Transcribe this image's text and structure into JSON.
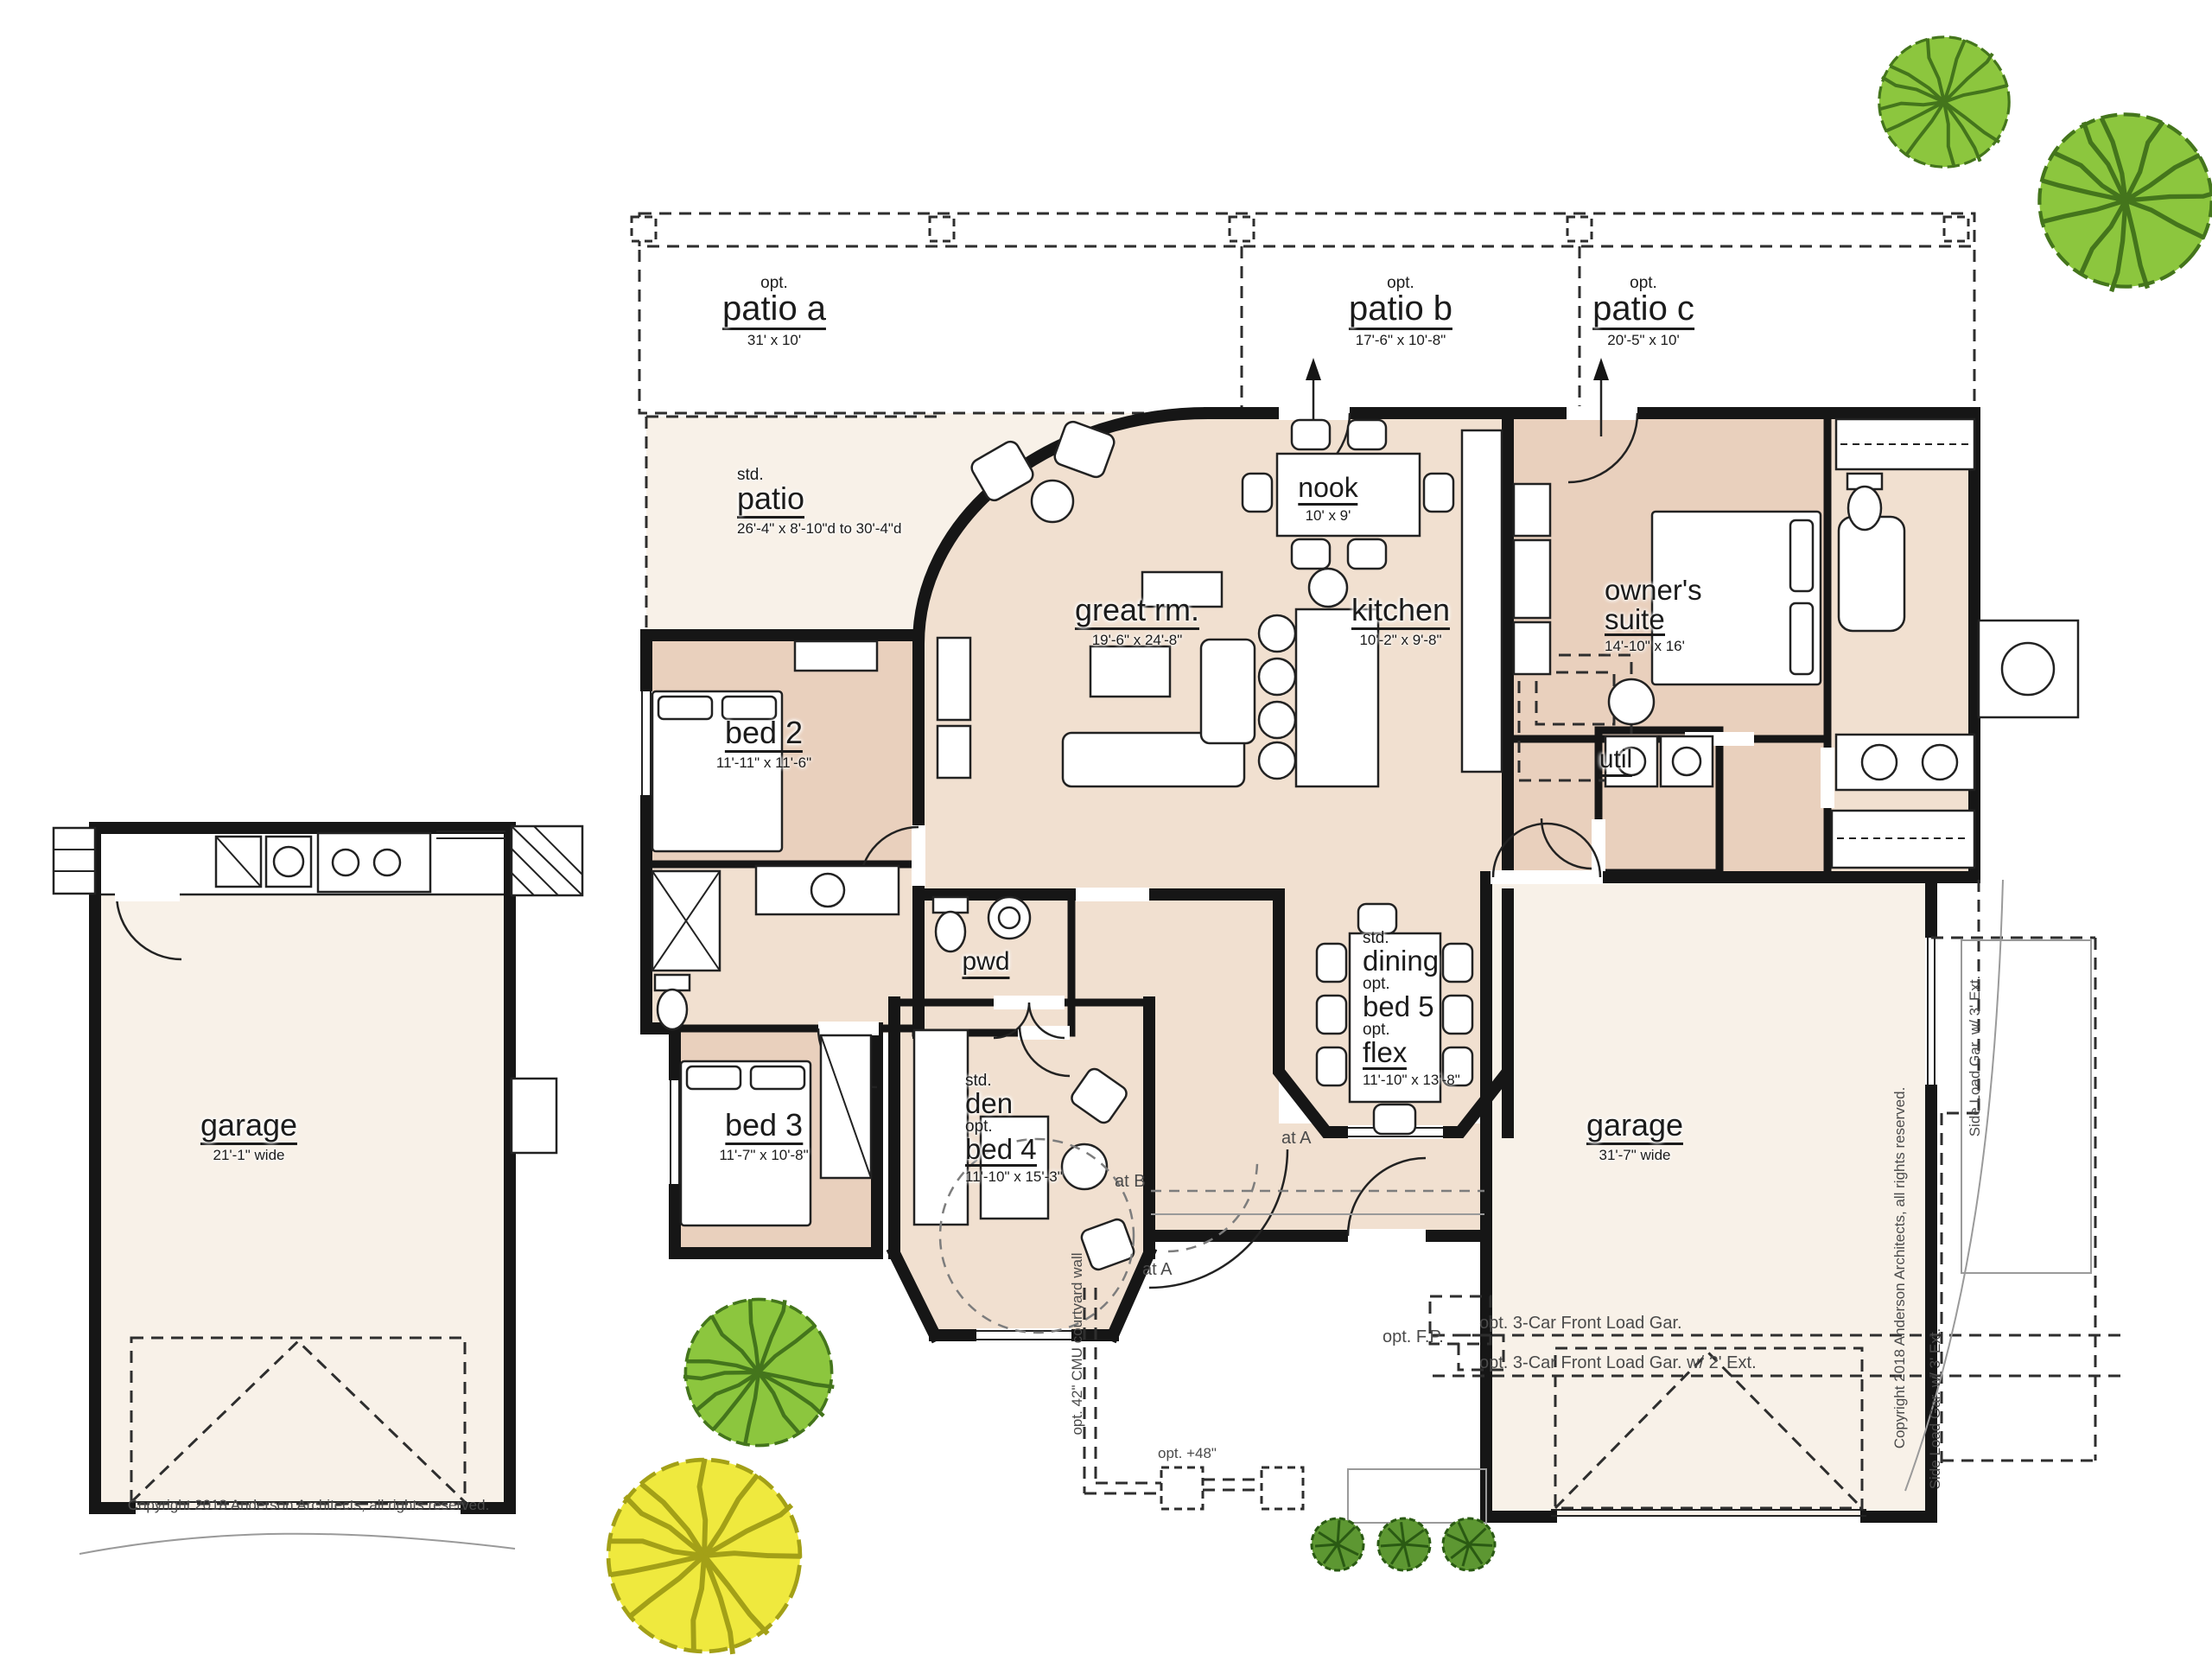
{
  "plan": {
    "patio_a": {
      "tag": "opt.",
      "name": "patio a",
      "dims": "31' x 10'"
    },
    "patio_b": {
      "tag": "opt.",
      "name": "patio b",
      "dims": "17'-6\" x 10'-8\""
    },
    "patio_c": {
      "tag": "opt.",
      "name": "patio c",
      "dims": "20'-5\" x 10'"
    },
    "patio_std": {
      "tag": "std.",
      "name": "patio",
      "dims": "26'-4\" x 8'-10\"d to 30'-4\"d"
    },
    "nook": {
      "name": "nook",
      "dims": "10' x 9'"
    },
    "great_room": {
      "name": "great rm.",
      "dims": "19'-6\" x 24'-8\""
    },
    "kitchen": {
      "name": "kitchen",
      "dims": "10'-2\" x 9'-8\""
    },
    "owners_suite": {
      "name_line1": "owner's",
      "name_line2": "suite",
      "dims": "14'-10\" x 16'"
    },
    "bed2": {
      "name": "bed 2",
      "dims": "11'-11\" x 11'-6\""
    },
    "util": {
      "name": "util"
    },
    "pwd": {
      "name": "pwd"
    },
    "dining": {
      "tag1": "std.",
      "name1": "dining",
      "tag2": "opt.",
      "name2": "bed 5",
      "tag3": "opt.",
      "name3": "flex",
      "dims": "11'-10\" x 13'-8\""
    },
    "bed3": {
      "name": "bed 3",
      "dims": "11'-7\" x 10'-8\""
    },
    "den": {
      "tag1": "std.",
      "name1": "den",
      "tag2": "opt.",
      "name2": "bed 4",
      "dims": "11'-10\" x 15'-3\""
    },
    "garage_left": {
      "name": "garage",
      "dims": "21'-1\" wide"
    },
    "garage_right": {
      "name": "garage",
      "dims": "31'-7\" wide"
    }
  },
  "annotations": {
    "copyright_left": "Copyright 2018 Anderson Architects, all rights reserved.",
    "copyright_right": "Copyright 2018 Anderson Architects, all rights reserved.",
    "opt_fp": "opt. F.P.",
    "opt_3car": "opt. 3-Car Front Load Gar.",
    "opt_3car_ext": "opt. 3-Car Front Load Gar. w/ 2' Ext.",
    "side_load_top": "Side Load Gar. w/ 3' Ext.",
    "side_load_bottom": "Side Load Gar. w/ 3' Ext.",
    "courtyard_wall": "opt. 42\" CMU courtyard wall",
    "opt_48": "opt. +48\"",
    "at_a_1": "at A",
    "at_b": "at B",
    "at_a_2": "at A"
  },
  "colors": {
    "wall": "#161616",
    "room": "#f1e0d0",
    "room_dark": "#e9d0bd",
    "cream": "#f8f1e8",
    "tree_fill": "#8cc63e",
    "tree_stroke": "#44751c",
    "ytree_fill": "#efe93e",
    "ytree_stroke": "#a3a017",
    "shrub_fill": "#5d9732",
    "shrub_stroke": "#2a5a13"
  }
}
